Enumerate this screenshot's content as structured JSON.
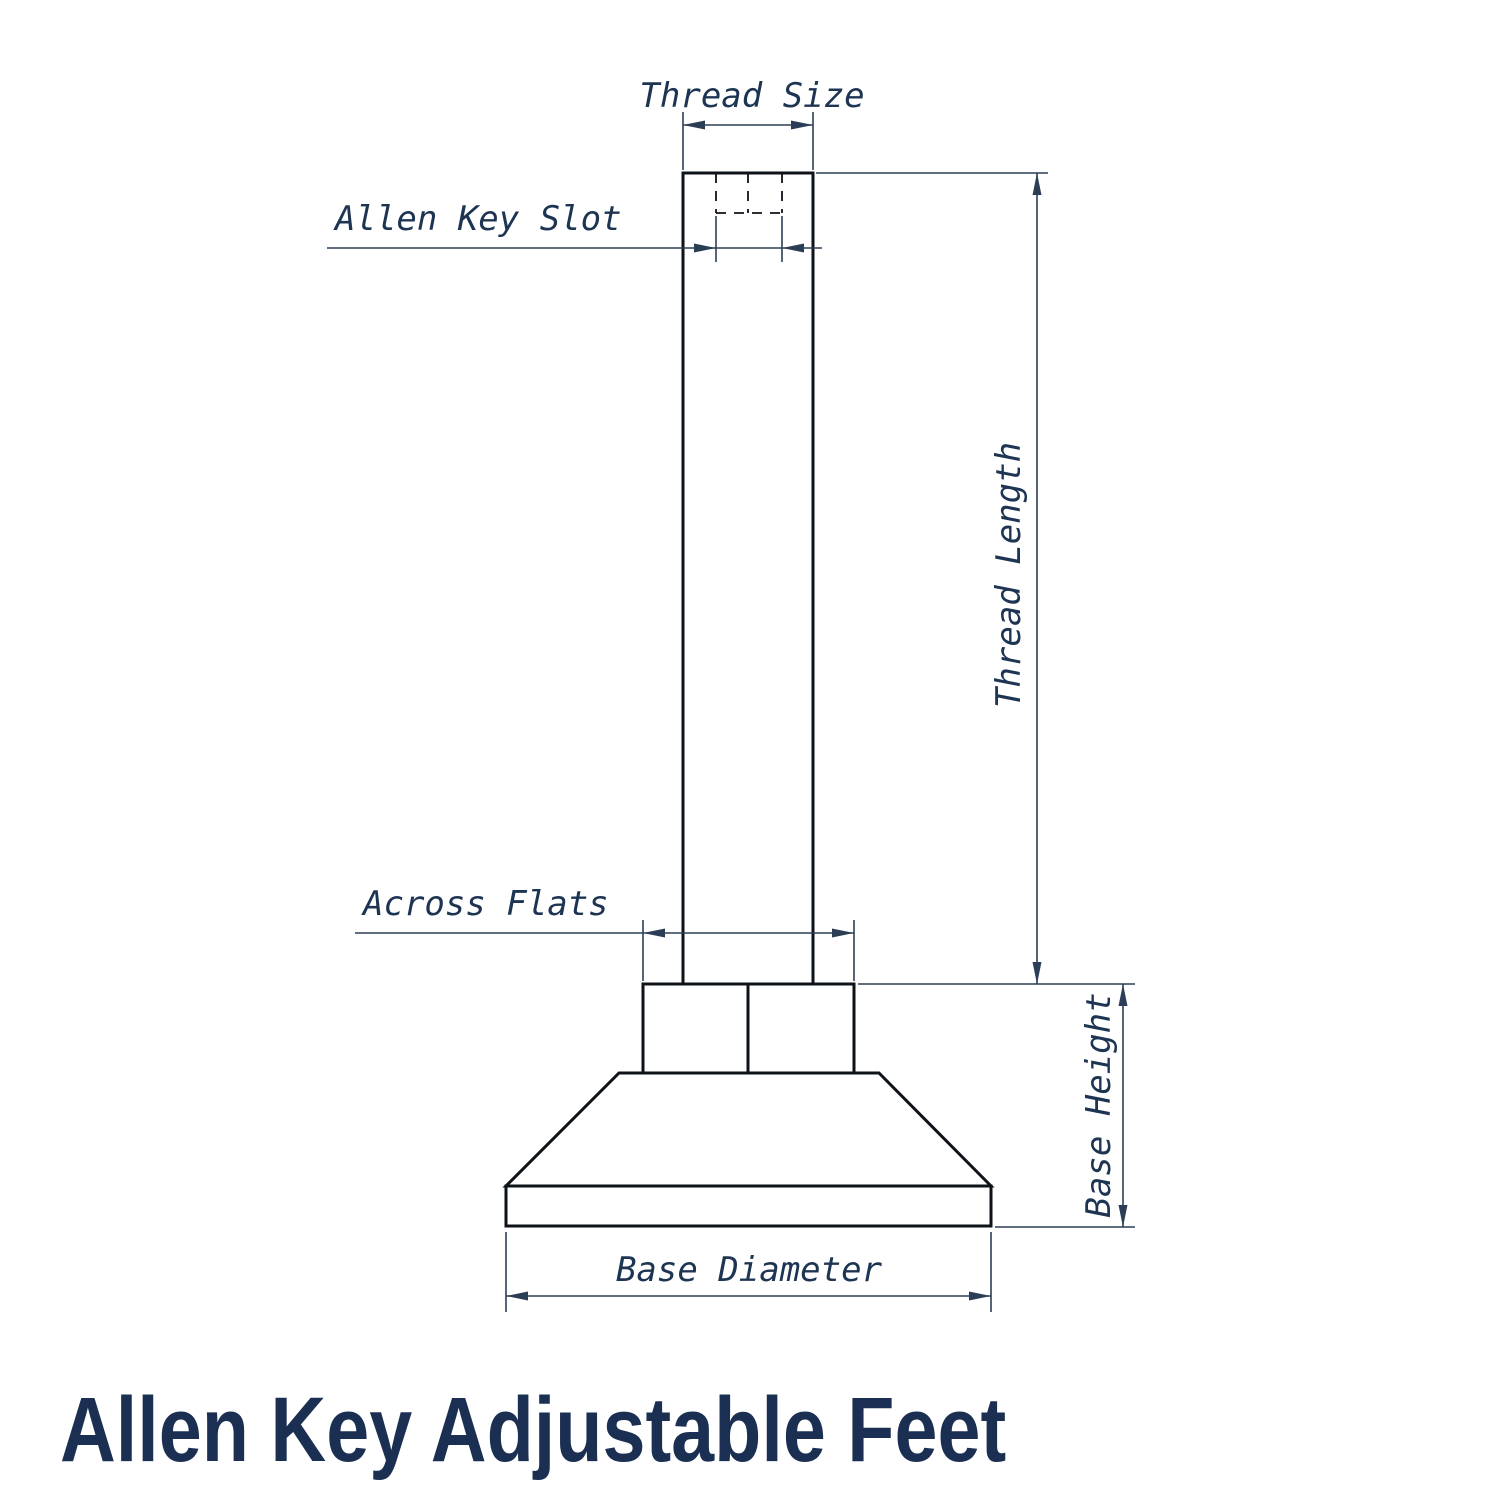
{
  "title": "Allen Key Adjustable Feet",
  "drawing": {
    "labels": {
      "thread_size": "Thread Size",
      "allen_key_slot": "Allen Key Slot",
      "thread_length": "Thread Length",
      "across_flats": "Across Flats",
      "base_height": "Base Height",
      "base_diameter": "Base Diameter"
    },
    "colors": {
      "object_line": "#0e1319",
      "dimension_line": "#2b3e55",
      "label_text": "#1d3452",
      "title_text": "#1a2f52",
      "background": "#ffffff"
    }
  }
}
